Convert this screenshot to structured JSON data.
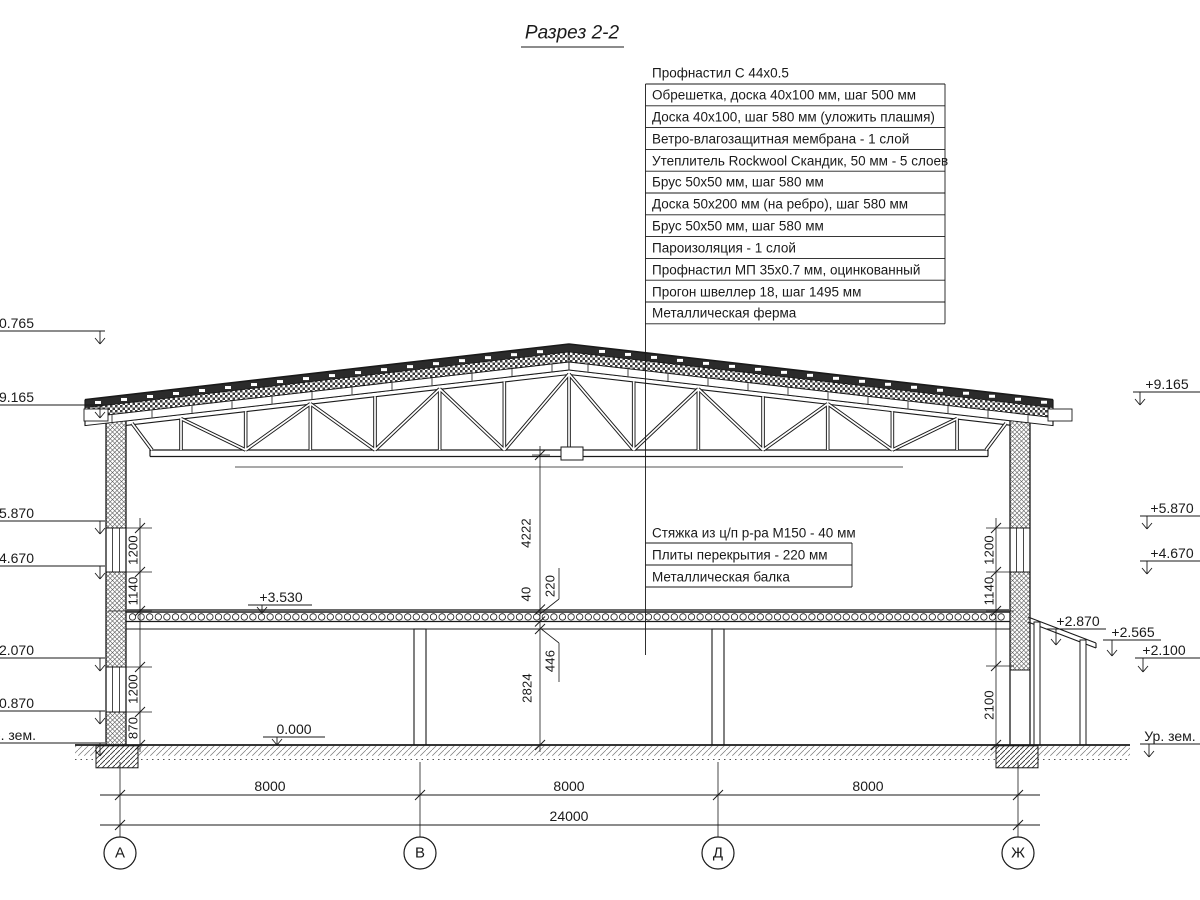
{
  "title": "Разрез 2-2",
  "roof_callouts": [
    "Профнастил С 44х0.5",
    "Обрешетка, доска 40х100 мм, шаг 500 мм",
    "Доска 40х100, шаг 580 мм (уложить плашмя)",
    "Ветро-влагозащитная мембрана - 1 слой",
    "Утеплитель Rockwool Скандик, 50 мм - 5 слоев",
    "Брус 50х50 мм, шаг 580 мм",
    "Доска 50х200 мм (на ребро), шаг 580 мм",
    "Брус 50х50 мм, шаг 580 мм",
    "Пароизоляция - 1 слой",
    "Профнастил МП 35х0.7 мм, оцинкованный",
    "Прогон швеллер 18, шаг 1495 мм",
    "Металлическая ферма"
  ],
  "floor_callouts": [
    "Стяжка из ц/п р-ра М150 - 40 мм",
    "Плиты перекрытия - 220 мм",
    "Металлическая балка"
  ],
  "elev_left": [
    "+10.765",
    "+9.165",
    "+5.870",
    "+4.670",
    "+2.070",
    "+0.870",
    "Ур. зем."
  ],
  "elev_right": [
    "+9.165",
    "+5.870",
    "+4.670",
    "+2.870",
    "+2.565",
    "+2.100",
    "Ур. зем."
  ],
  "marks": {
    "slab": "+3.530",
    "floor": "0.000"
  },
  "dims": {
    "v_center": [
      "4222",
      "40",
      "220",
      "446",
      "2824"
    ],
    "left": [
      "1200",
      "1140",
      "1200",
      "870"
    ],
    "right": [
      "1200",
      "1140",
      "2100"
    ],
    "spans": [
      "8000",
      "8000",
      "8000"
    ],
    "total": "24000"
  },
  "axes": [
    "А",
    "В",
    "Д",
    "Ж"
  ],
  "colors": {
    "ink": "#1a1a1a",
    "paper": "#ffffff"
  }
}
